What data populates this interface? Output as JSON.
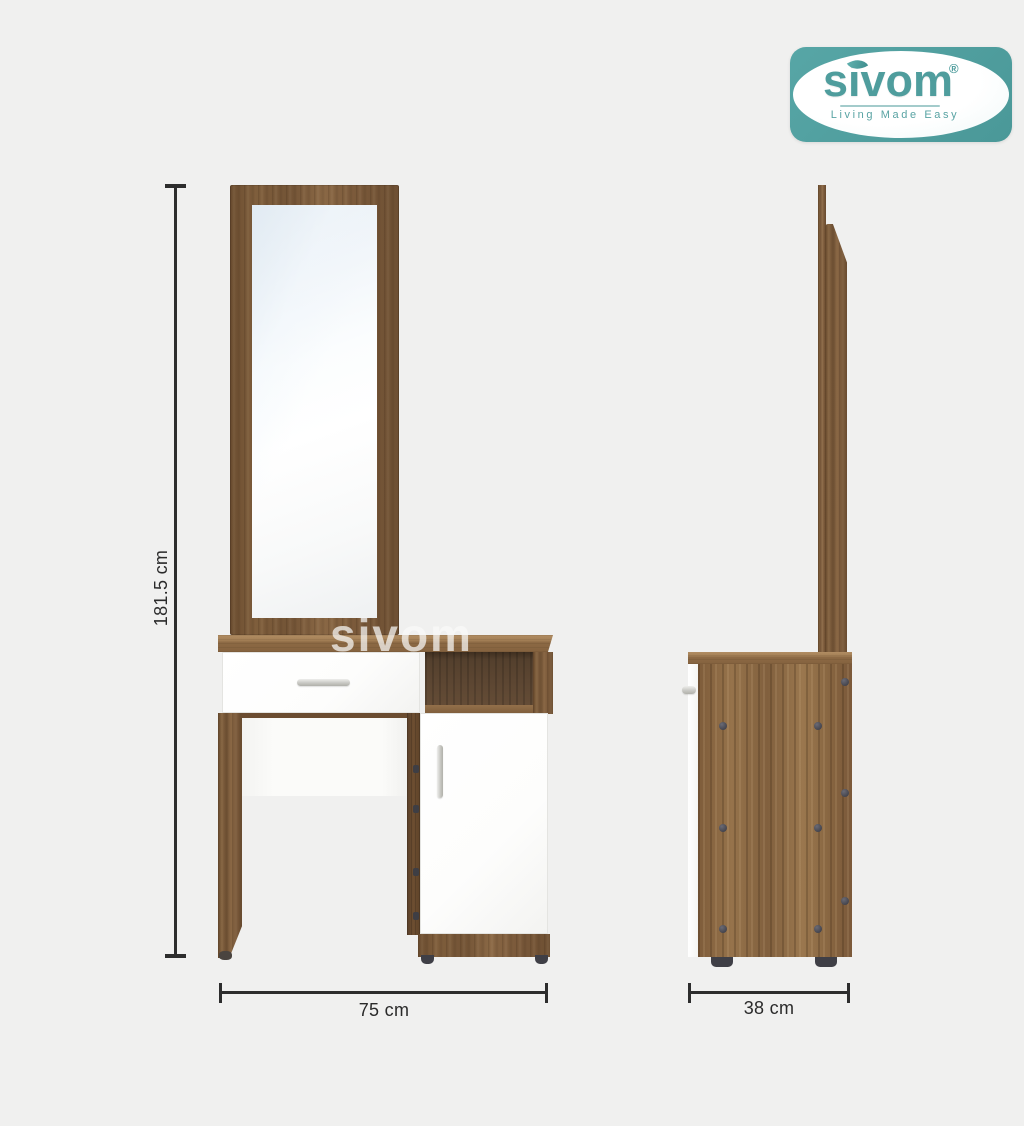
{
  "brand": {
    "name": "sivom",
    "registered": "®",
    "tagline": "Living Made Easy",
    "teal": "#4f9d9d"
  },
  "dimensions": {
    "height": "181.5 cm",
    "width": "75 cm",
    "depth": "38 cm"
  },
  "watermark": "sivom",
  "colors": {
    "background": "#f0f0ef",
    "wood_mid": "#7b5c3c",
    "wood_dark": "#5d4329",
    "wood_light": "#96734b",
    "dimension_line": "#2d2d2d",
    "panel_white": "#fdfdfc"
  }
}
